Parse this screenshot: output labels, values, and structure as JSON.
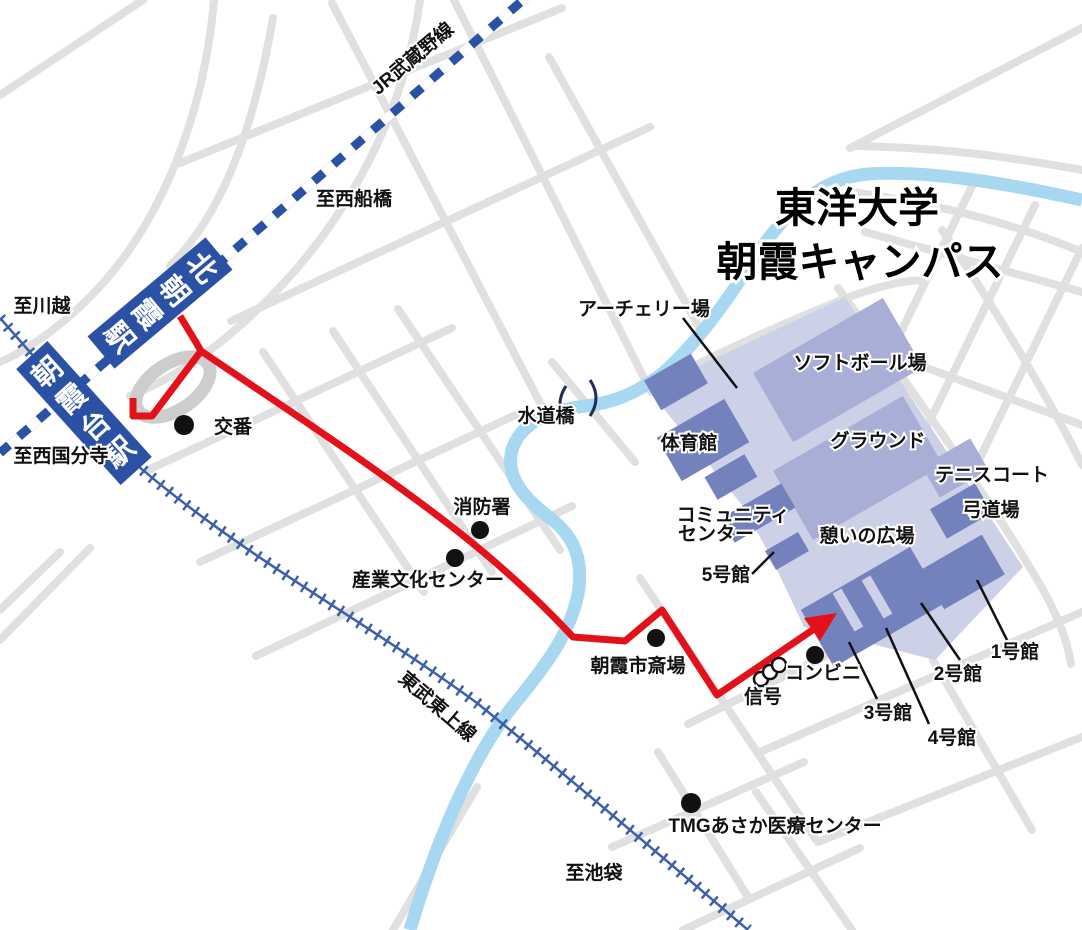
{
  "title": {
    "line1": "東洋大学",
    "line2": "朝霞キャンパス"
  },
  "railways": {
    "jr": {
      "name": "JR武蔵野線",
      "toward_east": "至西船橋",
      "toward_west": "至西国分寺"
    },
    "tobu": {
      "name": "東武東上線",
      "toward_north": "至川越",
      "toward_south": "至池袋"
    }
  },
  "stations": {
    "kita_asaka": {
      "name": "北朝霞駅",
      "chars": [
        "北",
        "朝",
        "霞",
        "駅"
      ]
    },
    "asakadai": {
      "name": "朝霞台駅",
      "chars": [
        "朝",
        "霞",
        "台",
        "駅"
      ]
    }
  },
  "campus": {
    "archery": "アーチェリー場",
    "softball": "ソフトボール場",
    "ground": "グラウンド",
    "gym": "体育館",
    "tennis": "テニスコート",
    "kyudo": "弓道場",
    "community_line1": "コミュニティ",
    "community_line2": "センター",
    "plaza": "憩いの広場",
    "bldg1": "1号館",
    "bldg2": "2号館",
    "bldg3": "3号館",
    "bldg4": "4号館",
    "bldg5": "5号館"
  },
  "landmarks": {
    "koban": "交番",
    "fire_station": "消防署",
    "industry_culture_center": "産業文化センター",
    "funeral_hall": "朝霞市斎場",
    "signal": "信号",
    "convenience_store": "コンビニ",
    "medical_center": "TMGあさか医療センター",
    "bridge": "水道橋"
  },
  "colors": {
    "campus_base": "#ccd1e8",
    "campus_field": "#a8aed6",
    "campus_building": "#7381bd",
    "rail_blue": "#2b51a5",
    "tobu_blue": "#3e5fa9",
    "route_red": "#e3111a",
    "river_blue": "#a7d7f1",
    "road_gray": "#e0e0e0"
  }
}
